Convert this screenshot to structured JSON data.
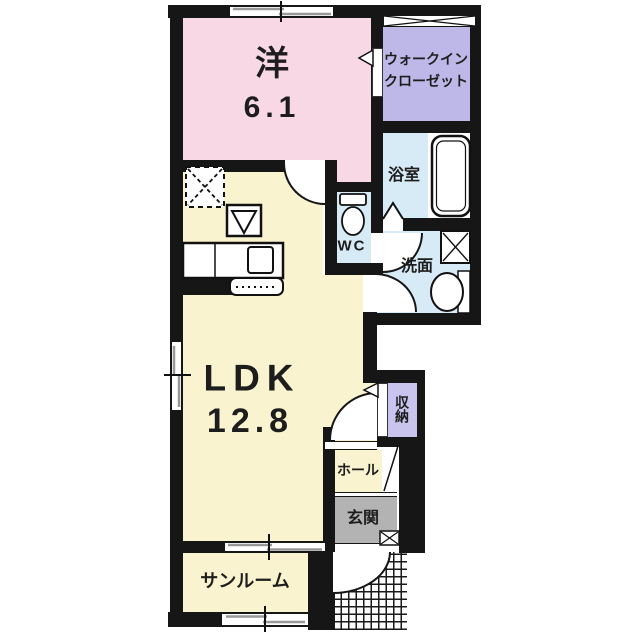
{
  "floorplan": {
    "rooms": {
      "western_room": {
        "label": "洋",
        "area": "6.1"
      },
      "walk_in_closet": {
        "label_line1": "ウォークイン",
        "label_line2": "クローゼット"
      },
      "bathroom": {
        "label": "浴室"
      },
      "toilet": {
        "label": "WC"
      },
      "washroom": {
        "label": "洗面"
      },
      "ldk": {
        "label": "LDK",
        "area": "12.8"
      },
      "storage": {
        "label": "収納"
      },
      "hall": {
        "label": "ホール"
      },
      "entrance": {
        "label": "玄関"
      },
      "sunroom": {
        "label": "サンルーム"
      }
    },
    "colors": {
      "western_room": "#f9d8e5",
      "walk_in_closet": "#bdb8e7",
      "storage": "#c9c4ee",
      "wet_area": "#d7ebf6",
      "ldk": "#faf3cf",
      "entrance": "#b3b3b3",
      "wall": "#161616",
      "background": "#ffffff"
    }
  }
}
